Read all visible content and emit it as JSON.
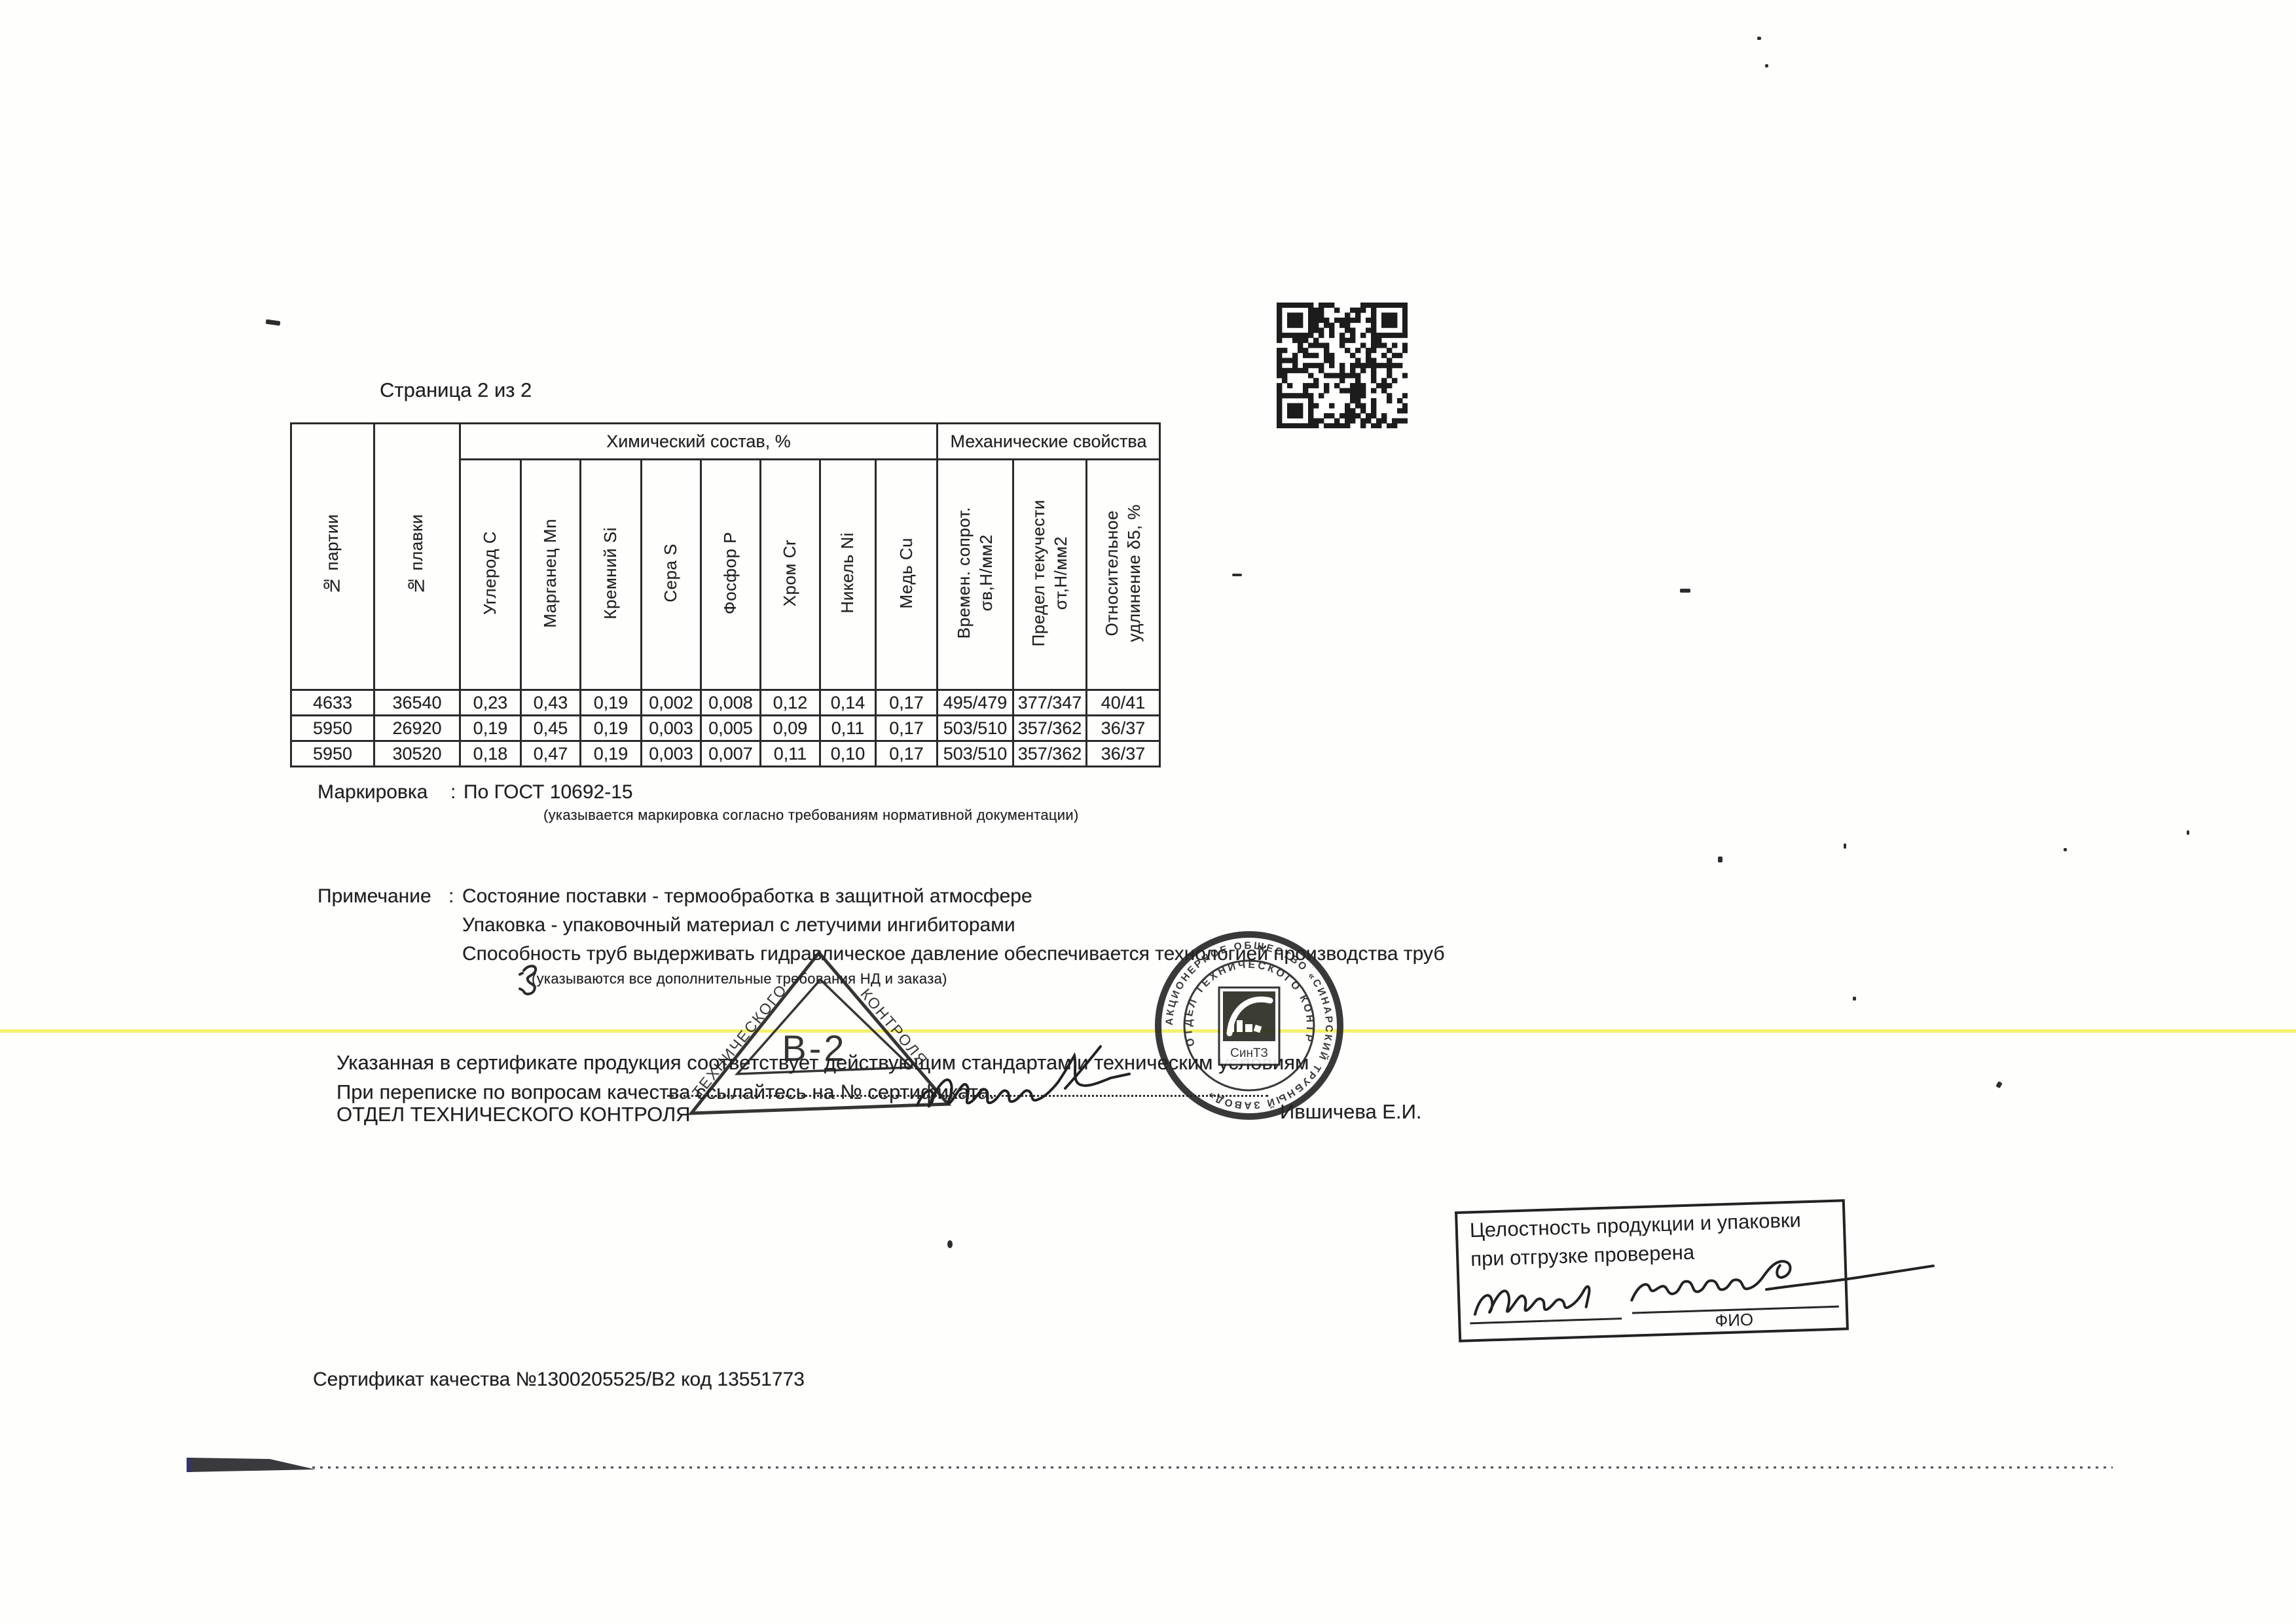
{
  "page_label": "Страница 2 из 2",
  "table": {
    "group_headers": {
      "chemical": "Химический состав, %",
      "mechanical": "Механические свойства"
    },
    "columns": [
      "№ партии",
      "№ плавки",
      "Углерод С",
      "Марганец Mn",
      "Кремний Si",
      "Сера S",
      "Фосфор Р",
      "Хром Cr",
      "Никель Ni",
      "Медь Cu",
      "Времен. сопрот.\nσв,Н/мм2",
      "Предел текучести\nσт,Н/мм2",
      "Относительное\nудлинение δ5, %"
    ],
    "rows": [
      [
        "4633",
        "36540",
        "0,23",
        "0,43",
        "0,19",
        "0,002",
        "0,008",
        "0,12",
        "0,14",
        "0,17",
        "495/479",
        "377/347",
        "40/41"
      ],
      [
        "5950",
        "26920",
        "0,19",
        "0,45",
        "0,19",
        "0,003",
        "0,005",
        "0,09",
        "0,11",
        "0,17",
        "503/510",
        "357/362",
        "36/37"
      ],
      [
        "5950",
        "30520",
        "0,18",
        "0,47",
        "0,19",
        "0,003",
        "0,007",
        "0,11",
        "0,10",
        "0,17",
        "503/510",
        "357/362",
        "36/37"
      ]
    ]
  },
  "marking": {
    "label": "Маркировка",
    "separator": ":",
    "value": "По ГОСТ 10692-15",
    "caption": "(указывается маркировка согласно требованиям нормативной документации)"
  },
  "note": {
    "label": "Примечание",
    "separator": ":",
    "lines": [
      "Состояние поставки - термообработка в защитной атмосфере",
      "Упаковка - упаковочный материал с летучими ингибиторами",
      "Способность труб выдерживать гидравлическое давление обеспечивается технологией производства труб"
    ],
    "caption": "(указываются все дополнительные требования НД и заказа)"
  },
  "statements": {
    "line1": "Указанная в сертификате продукция соответствует действующим стандартам и техническим условиям",
    "line2": "При переписке по вопросам качества ссылайтесь на № сертификата.",
    "department": "ОТДЕЛ ТЕХНИЧЕСКОГО КОНТРОЛЯ",
    "signer": "Ившичева Е.И."
  },
  "triangle_stamp": {
    "side_left": "ТЕХНИЧЕСКОГО",
    "side_right": "КОНТРОЛЯ",
    "center": "В-2"
  },
  "round_stamp": {
    "ring_outer": "АКЦИОНЕРНОЕ ОБЩЕСТВО «СИНАРСКИЙ ТРУБНЫЙ ЗАВОД»",
    "ring_inner": "ОТДЕЛ ТЕХНИЧЕСКОГО КОНТРОЛЯ",
    "logo": "СинТЗ"
  },
  "shipping_stamp": {
    "line1": "Целостность продукции и упаковки",
    "line2": "при отгрузке проверена",
    "caption": "ФИО"
  },
  "footer": {
    "certificate": "Сертификат качества №1300205525/В2 код 13551773"
  }
}
